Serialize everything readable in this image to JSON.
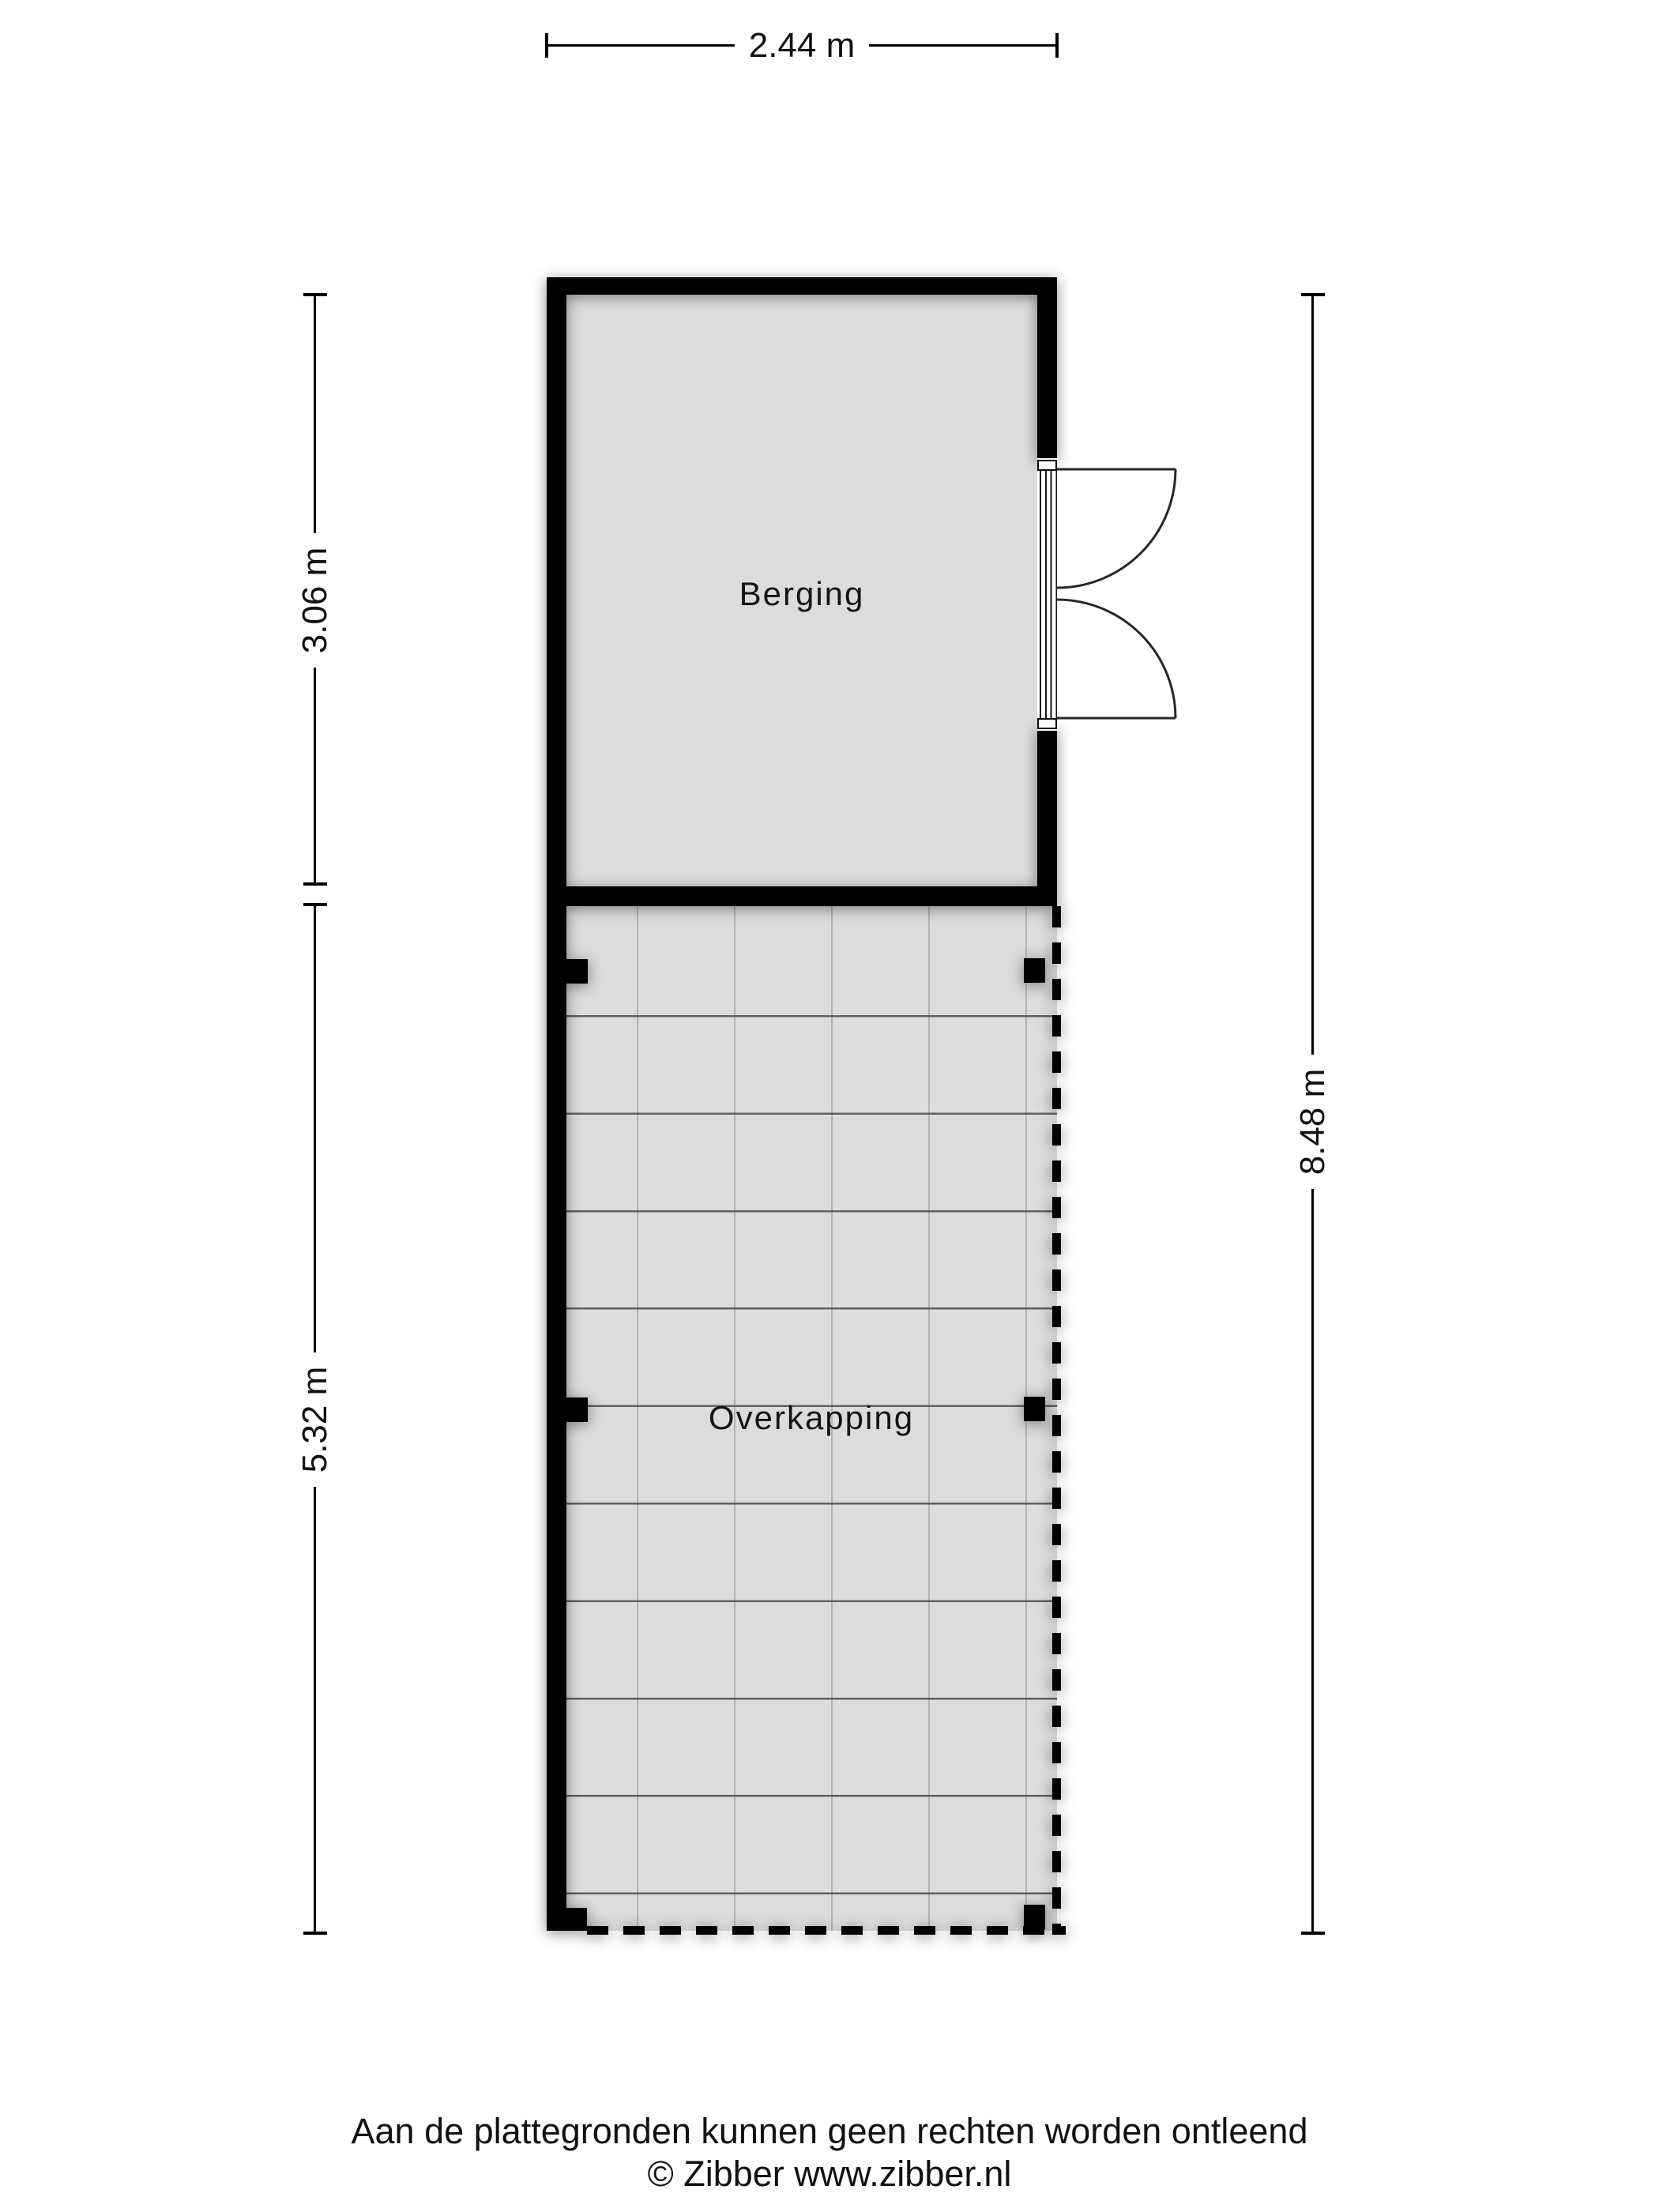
{
  "plan": {
    "rooms": [
      {
        "label": "Berging"
      },
      {
        "label": "Overkapping"
      }
    ],
    "dimensions": {
      "top": "2.44 m",
      "left_upper": "3.06 m",
      "left_lower": "5.32 m",
      "right": "8.48 m"
    },
    "symbols": [
      "double-door",
      "column-posts",
      "dashed-open-boundary",
      "tiled-floor-grid"
    ],
    "colors": {
      "wall": "#000000",
      "room_fill": "#dcdcdc",
      "grid_major": "#545454",
      "grid_minor": "#b3b3b3"
    }
  },
  "footer": {
    "disclaimer": "Aan de plattegronden kunnen geen rechten worden ontleend",
    "copyright": "© Zibber www.zibber.nl"
  }
}
